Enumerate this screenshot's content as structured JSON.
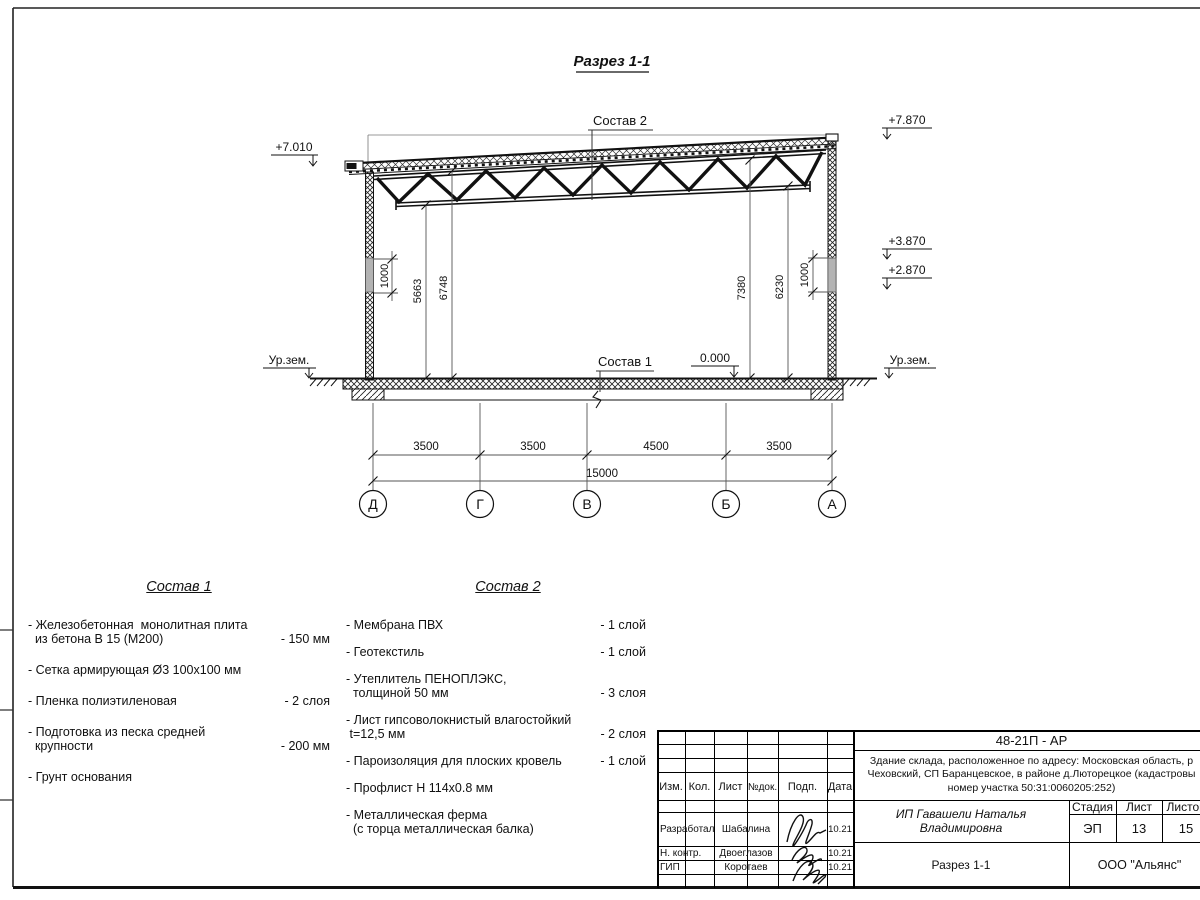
{
  "section": {
    "title": "Разрез 1-1",
    "sostav1_label": "Состав 1",
    "sostav2_label": "Состав 2",
    "elev_left": "+7.010",
    "elev_right_top": "+7.870",
    "elev_right_mid": "+3.870",
    "elev_right_low": "+2.870",
    "elev_zero": "0.000",
    "ground_left": "Ур.зем.",
    "ground_right": "Ур.зем.",
    "dims_vertical": [
      "1000",
      "5663",
      "6748",
      "7380",
      "6230",
      "1000"
    ],
    "dims_span": [
      "3500",
      "3500",
      "4500",
      "3500"
    ],
    "dim_total": "15000",
    "axes": [
      "Д",
      "Г",
      "В",
      "Б",
      "А"
    ]
  },
  "sostav1": {
    "title": "Состав 1",
    "items": [
      {
        "text": "- Железобетонная  монолитная плита\n  из бетона В 15 (М200)",
        "value": "- 150 мм"
      },
      {
        "text": "- Сетка армирующая Ø3 100х100 мм",
        "value": ""
      },
      {
        "text": "- Пленка полиэтиленовая",
        "value": "-  2 слоя"
      },
      {
        "text": "- Подготовка из песка средней\n  крупности",
        "value": "- 200 мм"
      },
      {
        "text": "- Грунт основания",
        "value": ""
      }
    ]
  },
  "sostav2": {
    "title": "Состав 2",
    "items": [
      {
        "text": "- Мембрана ПВХ",
        "value": "- 1 слой"
      },
      {
        "text": "- Геотекстиль",
        "value": "- 1 слой"
      },
      {
        "text": "- Утеплитель ПЕНОПЛЭКС,\n  толщиной 50 мм",
        "value": "- 3 слоя"
      },
      {
        "text": "- Лист гипсоволокнистый влагостойкий\n t=12,5 мм",
        "value": "- 2 слоя"
      },
      {
        "text": "- Пароизоляция для плоских кровель",
        "value": "- 1 слой"
      },
      {
        "text": "- Профлист Н 114х0.8 мм",
        "value": ""
      },
      {
        "text": "- Металлическая ферма\n  (с торца металлическая балка)",
        "value": ""
      }
    ]
  },
  "stamp": {
    "doc_code": "48-21П - АР",
    "desc_line1": "Здание склада, расположенное по адресу: Московская область, р",
    "desc_line2": "Чеховский, СП Баранцевское, в районе д.Люторецкое  (кадастровы",
    "desc_line3": "номер участка 50:31:0060205:252)",
    "cols": {
      "izm": "Изм.",
      "kol": "Кол.",
      "list": "Лист",
      "ndok": "№док.",
      "podp": "Подп.",
      "data": "Дата"
    },
    "roles": [
      {
        "role": "Разработал",
        "name": "Шабалина",
        "date": "10.21"
      },
      {
        "role": "Н. контр.",
        "name": "Двоеглазов",
        "date": "10.21"
      },
      {
        "role": "ГИП",
        "name": "Коротаев",
        "date": "10.21"
      }
    ],
    "client": "ИП Гавашели Наталья Владимировна",
    "stage_label": "Стадия",
    "sheet_label": "Лист",
    "sheets_label": "Листов",
    "stage": "ЭП",
    "sheet": "13",
    "sheets": "15",
    "sheet_name": "Разрез 1-1",
    "org": "ООО \"Альянс\""
  }
}
